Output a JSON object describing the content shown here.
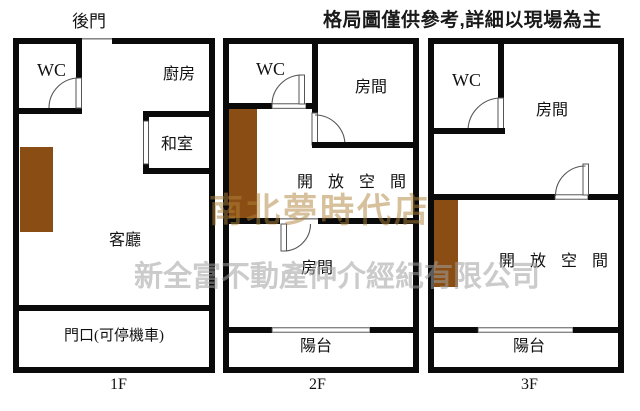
{
  "disclaimer": "格局圖僅供參考,詳細以現場為主",
  "watermarks": {
    "store": "南北夢時代店",
    "company": "新全富不動產仲介經紀有限公司"
  },
  "floor1": {
    "floor_label": "1F",
    "back_door": "後門",
    "rooms": {
      "wc": "WC",
      "kitchen": "廚房",
      "tatami": "和室",
      "living": "客廳",
      "entrance": "門口(可停機車)"
    }
  },
  "floor2": {
    "floor_label": "2F",
    "rooms": {
      "wc": "WC",
      "room_upper": "房間",
      "open_space": "開放空間",
      "room_lower": "房間",
      "balcony": "陽台"
    }
  },
  "floor3": {
    "floor_label": "3F",
    "rooms": {
      "wc": "WC",
      "room": "房間",
      "open_space": "開放空間",
      "balcony": "陽台"
    }
  },
  "icons": {
    "door_swing": "door-swing-arc",
    "window": "window-slot",
    "stairs": "stairs-block"
  },
  "colors": {
    "background": "#ffffff",
    "wall": "#0a0a0a",
    "stairs": "#8a4d13",
    "watermark_store": "#b0823a",
    "watermark_company": "#a0a0a0"
  }
}
